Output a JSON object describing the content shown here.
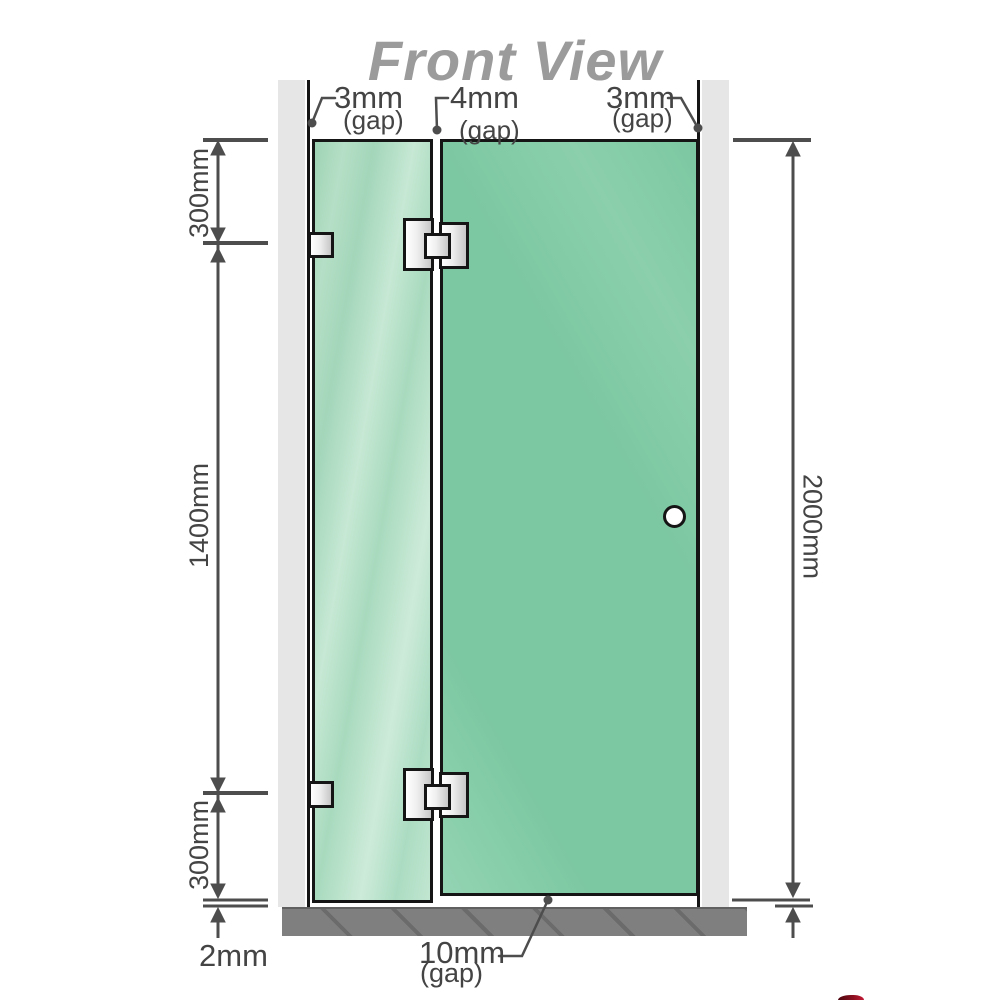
{
  "title": "Front View",
  "dims": {
    "left_top": "300mm",
    "left_middle": "1400mm",
    "left_bottom": "300mm",
    "right_height": "2000mm",
    "floor_gap": "2mm",
    "bottom_gap_value": "10mm",
    "bottom_gap_unit": "(gap)",
    "top_gap_left_value": "3mm",
    "top_gap_left_unit": "(gap)",
    "top_gap_middle_value": "4mm",
    "top_gap_middle_unit": "(gap)",
    "top_gap_right_value": "3mm",
    "top_gap_right_unit": "(gap)"
  },
  "colors": {
    "glass": "#7cc8a2",
    "glass-light": "#bfe4cf",
    "wall": "#e6e6e6",
    "floor": "#7f7f7f",
    "line": "#4d4d4d",
    "edge": "#151515",
    "title": "#9b9b9b",
    "logo-red": "#8e1020"
  }
}
